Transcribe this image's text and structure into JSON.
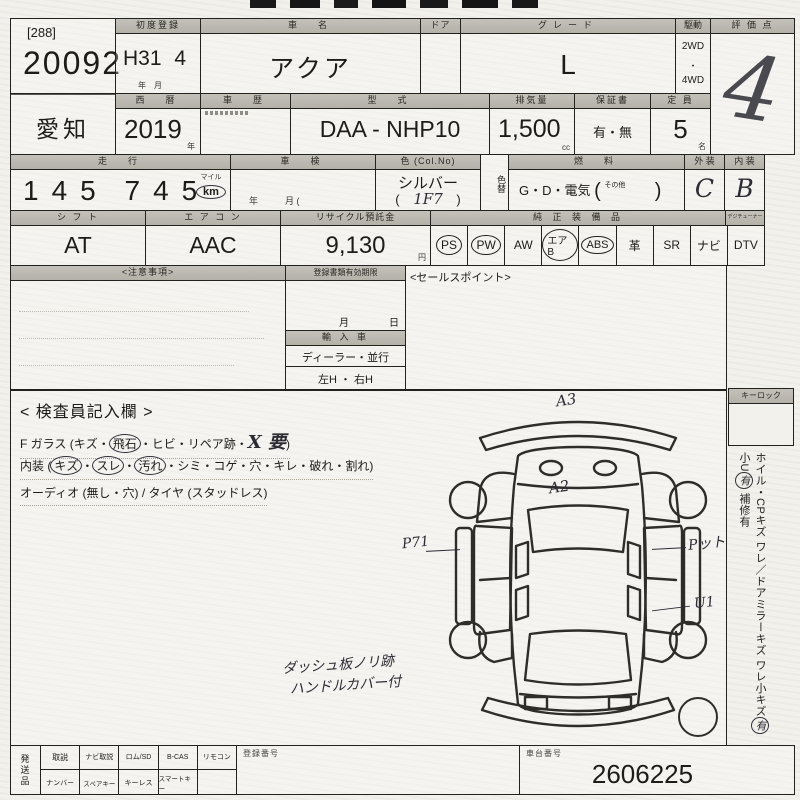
{
  "form": {
    "lot": {
      "bracket": "[288]",
      "number": "20092"
    },
    "first_registration": {
      "label": "初度登録",
      "era": "H31",
      "month": "4",
      "unit": "年　月"
    },
    "car_name": {
      "label": "車　名",
      "value": "アクア"
    },
    "door": {
      "label": "ドア"
    },
    "grade": {
      "label": "グレード",
      "value": "L"
    },
    "drive": {
      "label": "駆動",
      "option1": "2WD",
      "dot": "・",
      "option2": "4WD"
    },
    "score": {
      "label": "評 価 点",
      "handwritten": "4"
    },
    "prefecture": "愛知",
    "year": {
      "label": "西　暦",
      "value": "2019",
      "unit": "年"
    },
    "history": {
      "label": "車　歴"
    },
    "model": {
      "label": "型　式",
      "value": "DAA - NHP10"
    },
    "displacement": {
      "label": "排気量",
      "value": "1,500",
      "unit": "cc"
    },
    "warranty": {
      "label": "保証書",
      "value": "有・無"
    },
    "capacity": {
      "label": "定 員",
      "value": "5",
      "unit": "名"
    },
    "mileage": {
      "label": "走　行",
      "digits_a": "145",
      "digits_b": "745",
      "unit_top": "マイル",
      "unit": "km"
    },
    "shaken": {
      "label": "車　検",
      "sub": "年　　　月 ("
    },
    "color": {
      "label": "色 (Col.No)",
      "value": "シルバー",
      "code_open": "(",
      "code": "1F7",
      "code_close": ")"
    },
    "color_change": {
      "label": "色替"
    },
    "fuel": {
      "label": "燃　料",
      "value": "G・D・電気",
      "other": "その他"
    },
    "exterior": {
      "label": "外 装",
      "value": "C"
    },
    "interior": {
      "label": "内 装",
      "value": "B"
    },
    "shift": {
      "label": "シ フ ト",
      "value": "AT"
    },
    "aircon": {
      "label": "エ ア コ ン",
      "value": "AAC"
    },
    "recycle": {
      "label": "リサイクル預託金",
      "value": "9,130",
      "unit": "円"
    },
    "equipment": {
      "label": "純 正 装 備 品",
      "tuner_label": "デジチューナー",
      "items": [
        {
          "label": "PS",
          "circled": true
        },
        {
          "label": "PW",
          "circled": true
        },
        {
          "label": "AW",
          "circled": false
        },
        {
          "label": "エアB",
          "circled": true
        },
        {
          "label": "ABS",
          "circled": true
        },
        {
          "label": "革",
          "circled": false
        },
        {
          "label": "SR",
          "circled": false
        },
        {
          "label": "ナビ",
          "circled": false
        },
        {
          "label": "DTV",
          "circled": false
        }
      ]
    },
    "notes": {
      "label": "<注意事項>"
    },
    "validity": {
      "label": "登録書類有効期限",
      "sub": "月　　　　日"
    },
    "import": {
      "label": "輸 入 車",
      "options": "ディーラー・並行",
      "handle": "左H ・ 右H"
    },
    "sales_point": {
      "label": "<セールスポイント>"
    },
    "inspector": {
      "title": "< 検査員記入欄 >",
      "line1_prefix": "F ガラス (キズ・",
      "line1_oval": "飛石",
      "line1_mid": "・ヒビ・リペア跡・",
      "line1_hand": "X 要",
      "line1_suffix": ")",
      "line2_prefix": "内装 (",
      "line2_oval1": "キズ",
      "sep": "・",
      "line2_oval2": "スレ",
      "line2_oval3": "汚れ",
      "line2_suffix": "・シミ・コゲ・穴・キレ・破れ・割れ)",
      "line3": "オーディオ (無し・穴) / タイヤ (スタッドレス)",
      "hand_note1": "ダッシュ板ノリ跡",
      "hand_note2": "ハンドルカバー付"
    },
    "keylock": {
      "label": "キーロック"
    },
    "side_note": {
      "part1": "ホイル・CPキズ ワレ／ドアミラーキズ ワレ",
      "part2": "小キズ",
      "oval1": "有",
      "part3": " 小U",
      "oval2": "有",
      "part4": " 補修有"
    },
    "diagram_marks": {
      "front": "A3",
      "hood": "A2",
      "left": "P71",
      "right": "Pット",
      "right_rear": "U1"
    },
    "shipping": {
      "label": "発送品",
      "row1": [
        "取説",
        "ナビ取説",
        "ロム/SD",
        "B-CAS",
        "リモコン"
      ],
      "row2": [
        "ナンバー",
        "スペアキー",
        "キーレス",
        "スマートキー"
      ]
    },
    "registration": {
      "label": "登録番号"
    },
    "chassis": {
      "label": "車台番号",
      "value": "2606225"
    }
  }
}
